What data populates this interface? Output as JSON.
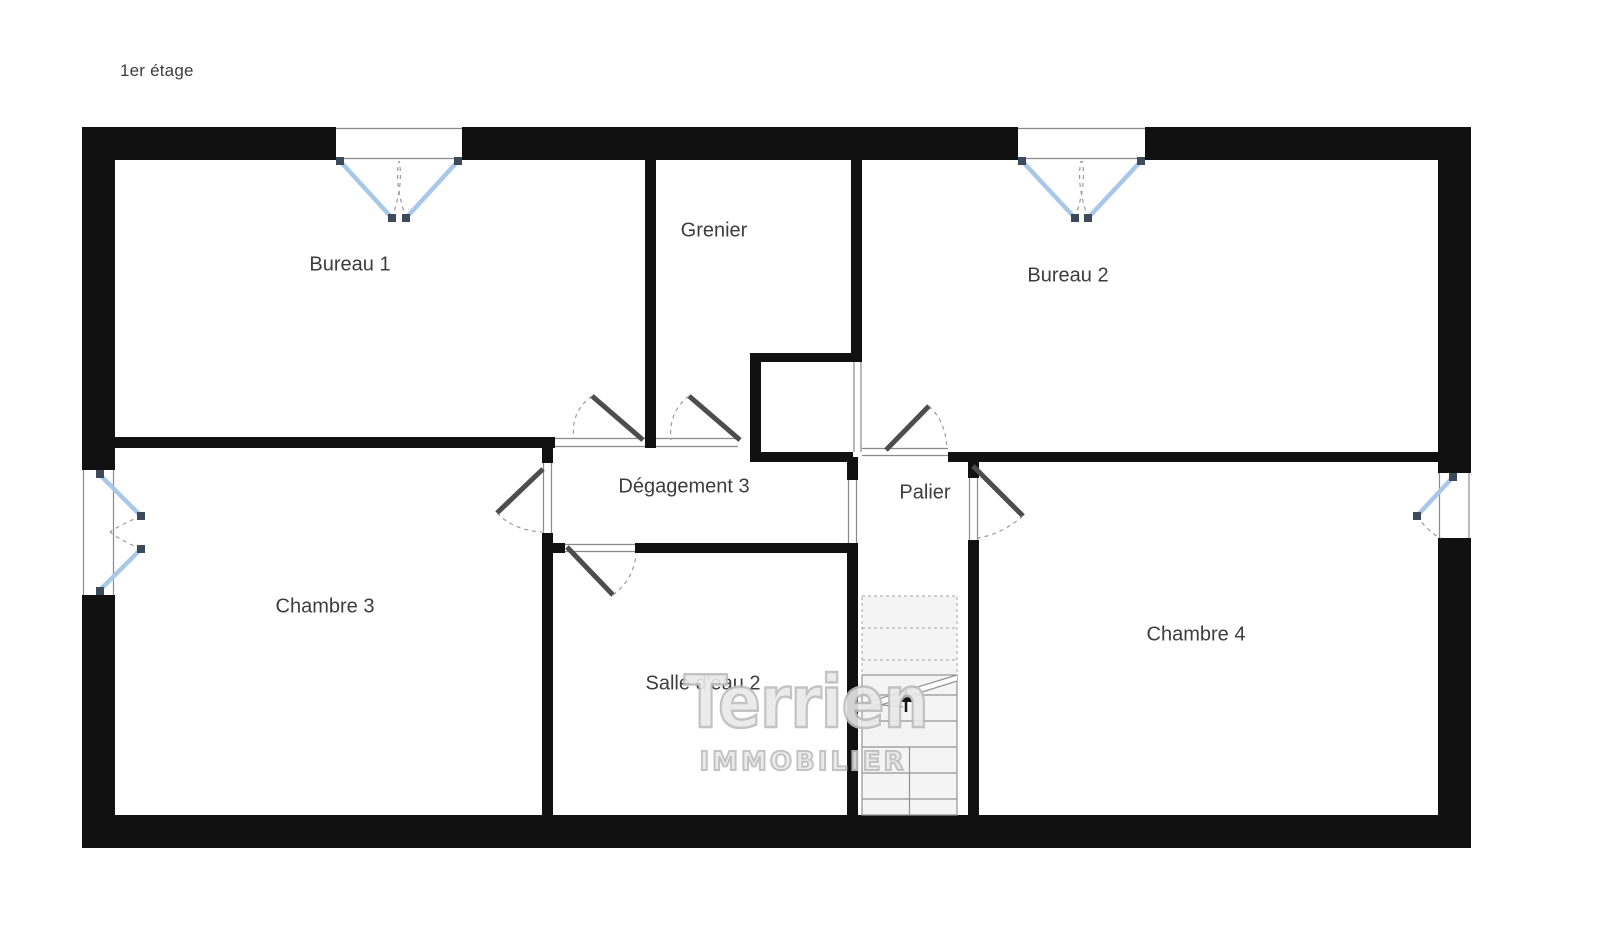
{
  "title": "1er étage",
  "rooms": {
    "bureau1": "Bureau 1",
    "grenier": "Grenier",
    "bureau2": "Bureau 2",
    "degagement3": "Dégagement 3",
    "palier": "Palier",
    "chambre3": "Chambre 3",
    "salle_deau2": "Salle d'eau 2",
    "chambre4": "Chambre 4"
  },
  "watermark": {
    "brand": "Terrien",
    "tagline": "IMMOBILIER"
  },
  "colors": {
    "wall": "#111111",
    "thin": "#8a8a8a",
    "window": "#a9c7e8",
    "cap": "#3d4a5a",
    "door": "#4d4d4d",
    "arc": "#9a9a9a",
    "stairFill": "#f4f4f4",
    "stairDash": "#b3b3b3",
    "stairLine": "#949494",
    "label": "#3d3d3d",
    "watermarkFill": "#e9e9e9",
    "watermarkStroke": "#bdbdbd"
  }
}
